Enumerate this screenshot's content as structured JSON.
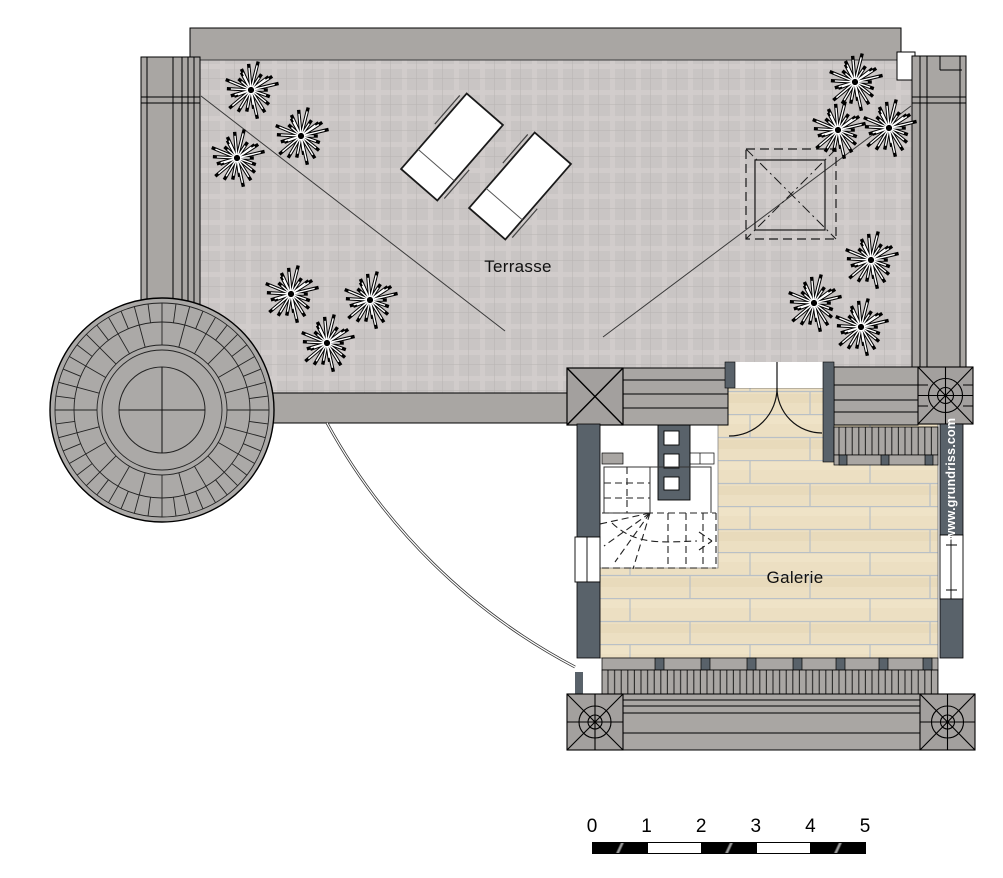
{
  "plan": {
    "labels": {
      "terrace": "Terrasse",
      "gallery": "Galerie"
    },
    "watermark": "www.grundriss.com",
    "scale_bar": {
      "ticks": [
        "0",
        "1",
        "2",
        "3",
        "4",
        "5"
      ]
    },
    "colors": {
      "wall": "#a9a6a3",
      "pillar": "#a3a09e",
      "dark_wall": "#59626a",
      "terrace_floor": "#c9c5c4",
      "wood_floor": "#ecdfc2",
      "line": "#1a1a1a"
    },
    "plants": [
      {
        "x": 251,
        "y": 90
      },
      {
        "x": 301,
        "y": 136
      },
      {
        "x": 237,
        "y": 158
      },
      {
        "x": 291,
        "y": 294
      },
      {
        "x": 370,
        "y": 300
      },
      {
        "x": 327,
        "y": 343
      },
      {
        "x": 855,
        "y": 82
      },
      {
        "x": 838,
        "y": 130
      },
      {
        "x": 889,
        "y": 128
      },
      {
        "x": 871,
        "y": 260
      },
      {
        "x": 814,
        "y": 303
      },
      {
        "x": 861,
        "y": 327
      }
    ],
    "loungers": [
      {
        "cx": 452,
        "cy": 147,
        "angle": -49
      },
      {
        "cx": 520,
        "cy": 186,
        "angle": -49
      }
    ]
  }
}
